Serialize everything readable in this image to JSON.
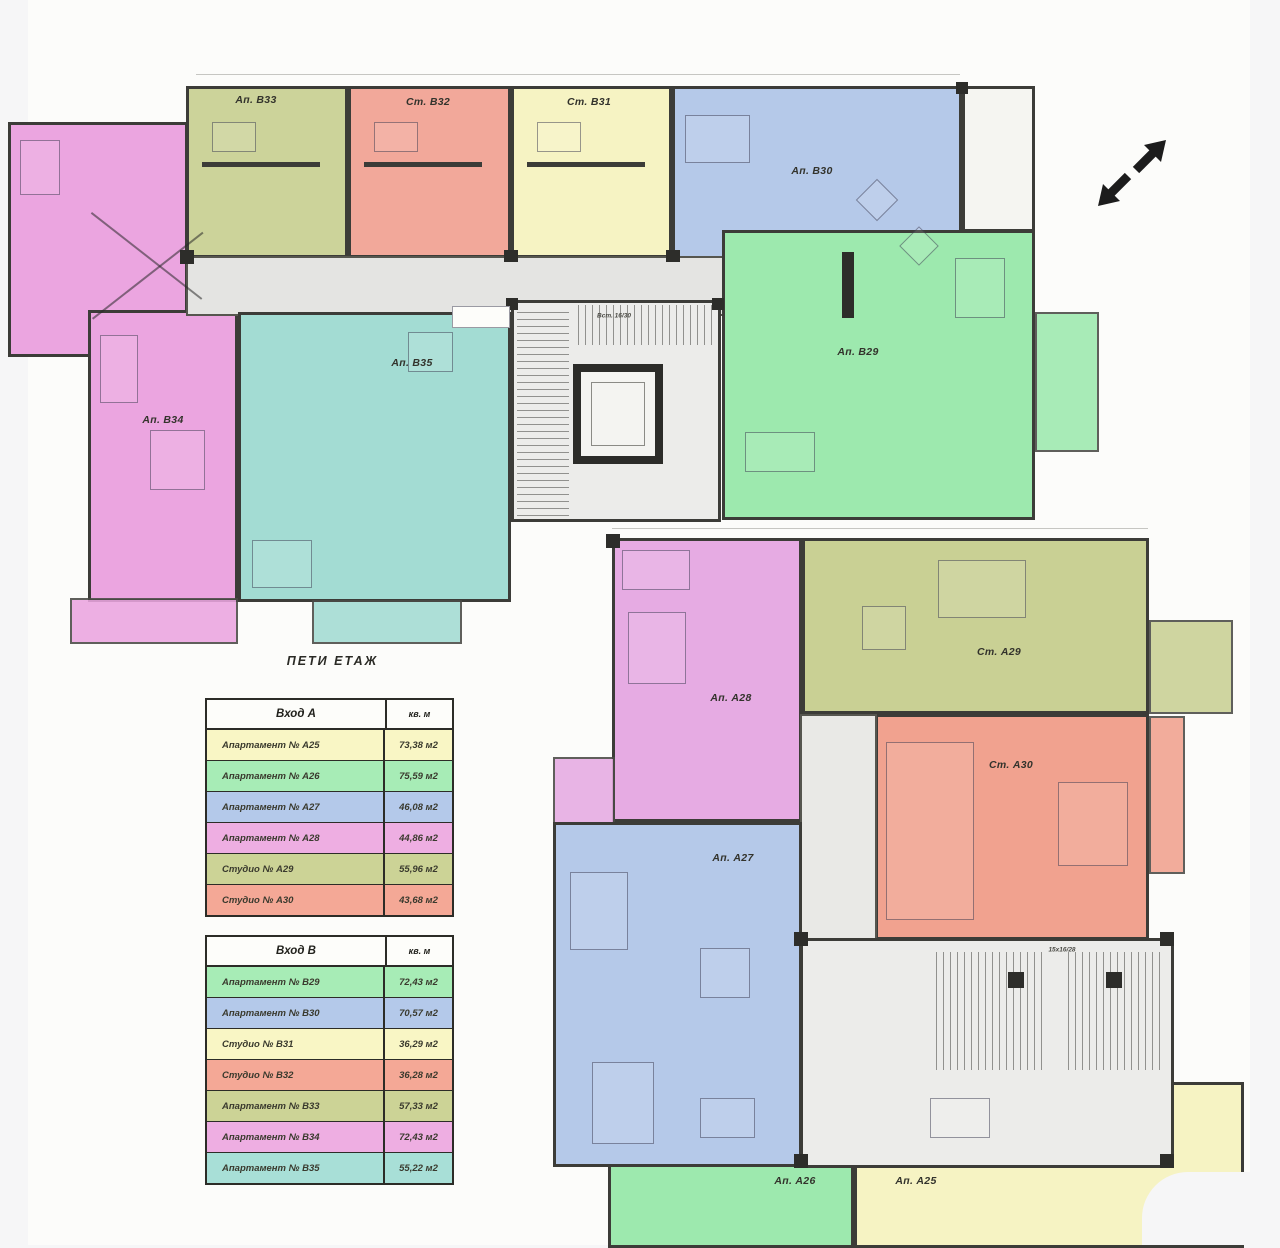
{
  "title": "ПЕТИ ЕТАЖ",
  "legend": {
    "entrance_a": {
      "header": {
        "name": "Вход А",
        "unit": "кв. м"
      },
      "rows": [
        {
          "label": "Апартамент № А25",
          "area": "73,38 м2",
          "color": "#f9f6c5"
        },
        {
          "label": "Апартамент № А26",
          "area": "75,59 м2",
          "color": "#a7ecb6"
        },
        {
          "label": "Апартамент № А27",
          "area": "46,08 м2",
          "color": "#b4c9ea"
        },
        {
          "label": "Апартамент № А28",
          "area": "44,86 м2",
          "color": "#eeaee2"
        },
        {
          "label": "Студио  № А29",
          "area": "55,96 м2",
          "color": "#ccd396"
        },
        {
          "label": "Студио  № А30",
          "area": "43,68 м2",
          "color": "#f4a896"
        }
      ]
    },
    "entrance_b": {
      "header": {
        "name": "Вход В",
        "unit": "кв. м"
      },
      "rows": [
        {
          "label": "Апартамент № В29",
          "area": "72,43 м2",
          "color": "#a7ecb6"
        },
        {
          "label": "Апартамент № В30",
          "area": "70,57 м2",
          "color": "#b4c9ea"
        },
        {
          "label": "Студио  № В31",
          "area": "36,29 м2",
          "color": "#f9f6c5"
        },
        {
          "label": "Студио  № В32",
          "area": "36,28 м2",
          "color": "#f4a896"
        },
        {
          "label": "Апартамент № В33",
          "area": "57,33 м2",
          "color": "#ccd396"
        },
        {
          "label": "Апартамент № В34",
          "area": "72,43 м2",
          "color": "#eeaee2"
        },
        {
          "label": "Апартамент № В35",
          "area": "55,22 м2",
          "color": "#a8dfd7"
        }
      ]
    }
  },
  "rooms": {
    "b33": {
      "label": "Ап. В33",
      "color": "#ccd39a"
    },
    "b32": {
      "label": "Ст. В32",
      "color": "#f2a89a"
    },
    "b31": {
      "label": "Ст. В31",
      "color": "#f6f3c3"
    },
    "b30": {
      "label": "Ап. В30",
      "color": "#b5c9e9"
    },
    "b34": {
      "label": "Ап. В34",
      "color": "#eba5e0"
    },
    "b35": {
      "label": "Ап. В35",
      "color": "#a3dcd3"
    },
    "b29": {
      "label": "Ап. В29",
      "color": "#9de9ae"
    },
    "a28": {
      "label": "Ап. А28",
      "color": "#e6abe3"
    },
    "a29": {
      "label": "Ст. А29",
      "color": "#c9d094"
    },
    "a30": {
      "label": "Ст. А30",
      "color": "#f1a28f"
    },
    "a27": {
      "label": "Ап. А27",
      "color": "#b5c9e9"
    },
    "a26": {
      "label": "Ап. А26",
      "color": "#9de9ae"
    },
    "a25": {
      "label": "Ап. А25",
      "color": "#f6f3c3"
    }
  },
  "stairs": {
    "label_b": "Вст. 16/30",
    "label_a": "15x16/28"
  }
}
